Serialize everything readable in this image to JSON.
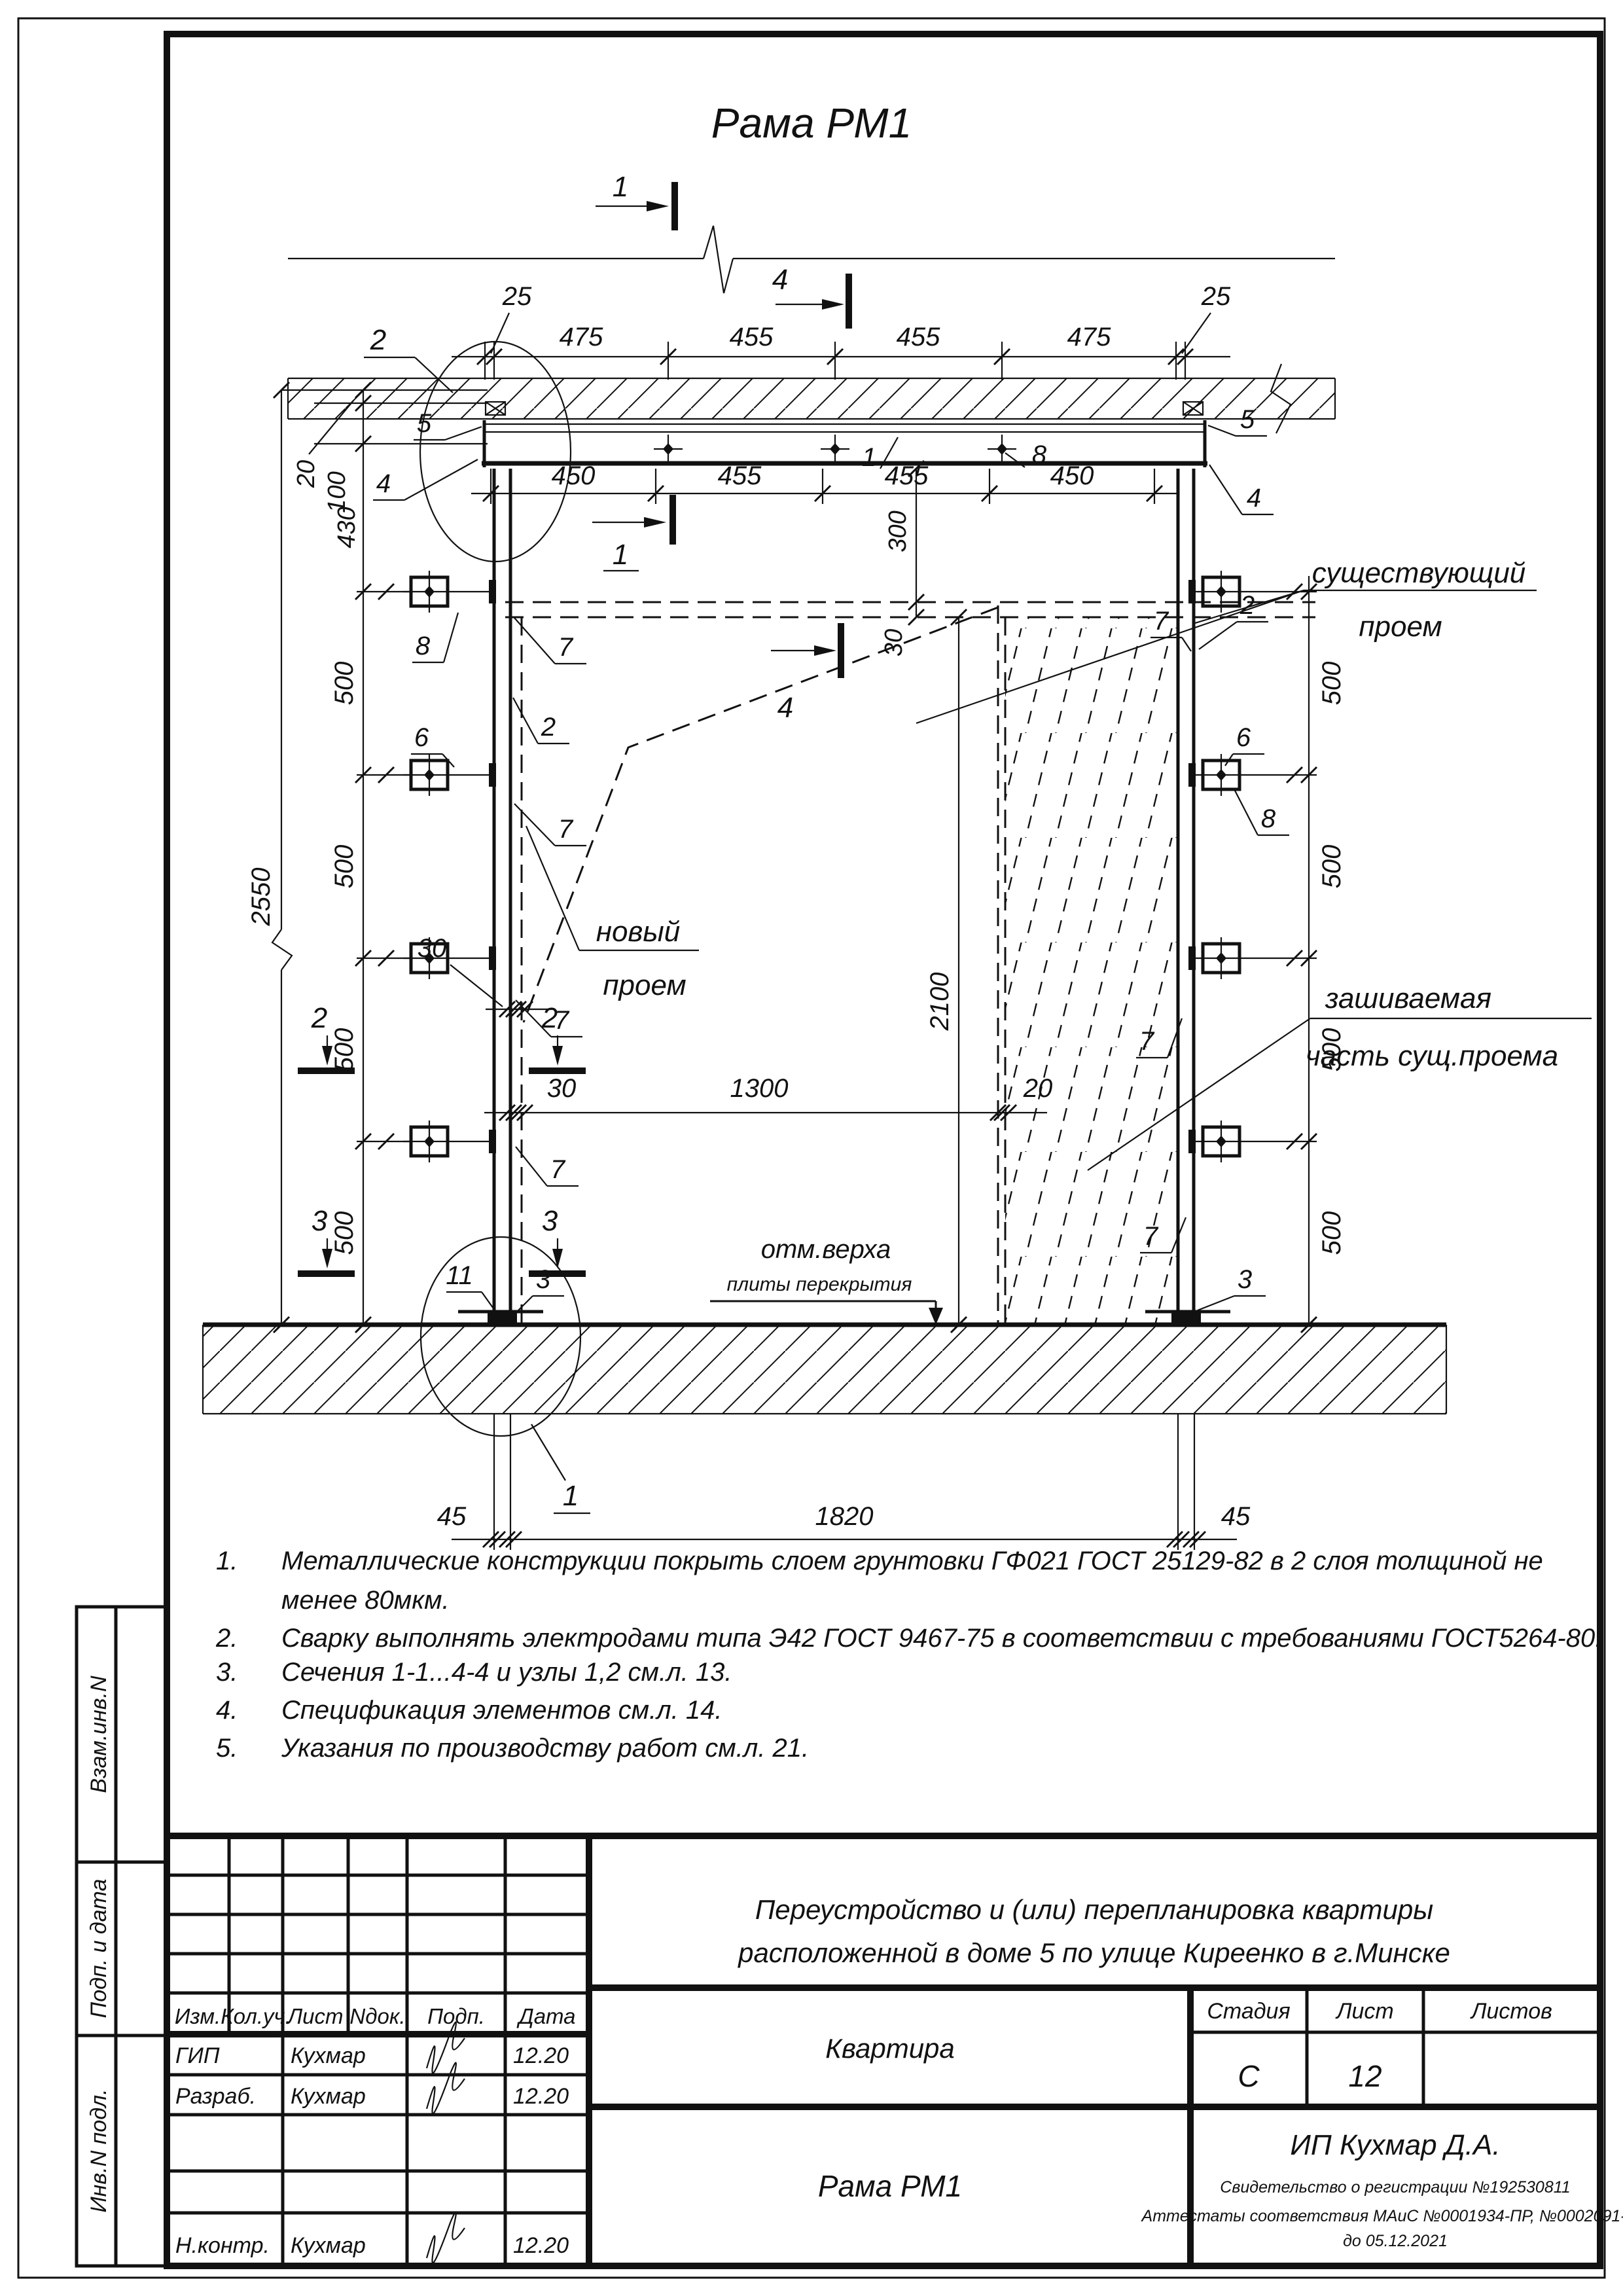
{
  "drawing": {
    "title": "Рама РМ1",
    "labels": {
      "existing1": "существующий",
      "existing2": "проем",
      "new1": "новый",
      "new2": "проем",
      "closing1": "зашиваемая",
      "closing2": "часть сущ.проема",
      "elev1": "отм.верха",
      "elev2": "плиты перекрытия"
    },
    "dims": {
      "top": [
        "25",
        "475",
        "455",
        "455",
        "475",
        "25"
      ],
      "beam": [
        "450",
        "455",
        "455",
        "450"
      ],
      "left": [
        "20",
        "100",
        "430",
        "500",
        "500",
        "500",
        "500"
      ],
      "right": [
        "500",
        "500",
        "500",
        "500"
      ],
      "overall": "2550",
      "mid": [
        "30",
        "1300",
        "20"
      ],
      "vmid": [
        "300",
        "30",
        "2100"
      ],
      "gap30": "30",
      "bottom": [
        "45",
        "1820",
        "45"
      ]
    },
    "sections": {
      "s1": "1",
      "s2": "2",
      "s3": "3",
      "s4": "4"
    },
    "nodes": {
      "n1": "1",
      "n2": "2"
    },
    "elems": {
      "e1": "1",
      "e2": "2",
      "e3": "3",
      "e4": "4",
      "e5": "5",
      "e6": "6",
      "e7": "7",
      "e8": "8",
      "e11": "11"
    }
  },
  "notes": {
    "items": [
      {
        "num": "1.",
        "text": "Металлические конструкции покрыть слоем грунтовки ГФ021 ГОСТ 25129-82 в 2 слоя толщиной не",
        "text2": "менее 80мкм."
      },
      {
        "num": "2.",
        "text": "Сварку выполнять электродами типа Э42 ГОСТ 9467-75 в соответствии с требованиями ГОСТ5264-80."
      },
      {
        "num": "3.",
        "text": "Сечения 1-1...4-4 и узлы 1,2 см.л. 13."
      },
      {
        "num": "4.",
        "text": "Спецификация элементов см.л. 14."
      },
      {
        "num": "5.",
        "text": "Указания по производству работ см.л. 21."
      }
    ]
  },
  "sidebar": {
    "vzam": "Взам.инв.N",
    "podp": "Подп. и дата",
    "inv": "Инв.N подл."
  },
  "titleblock": {
    "cols": [
      "Изм.",
      "Кол.уч.",
      "Лист",
      "Nдок.",
      "Подп.",
      "Дата"
    ],
    "rows": [
      {
        "role": "ГИП",
        "name": "Кухмар",
        "date": "12.20"
      },
      {
        "role": "Разраб.",
        "name": "Кухмар",
        "date": "12.20"
      },
      {
        "role": "Н.контр.",
        "name": "Кухмар",
        "date": "12.20"
      }
    ],
    "project1": "Переустройство и (или) перепланировка квартиры",
    "project2": "расположенной в доме 5 по улице Киреенко в г.Минске",
    "object": "Квартира",
    "doc": "Рама РМ1",
    "stage_label": "Стадия",
    "sheet_label": "Лист",
    "sheets_label": "Листов",
    "stage": "С",
    "sheet": "12",
    "firm": "ИП Кухмар Д.А.",
    "cert1": "Свидетельство о регистрации №192530811",
    "cert2": "Аттестаты соответствия МАиС №0001934-ПР, №0002091-ПР",
    "cert3": "до 05.12.2021"
  }
}
